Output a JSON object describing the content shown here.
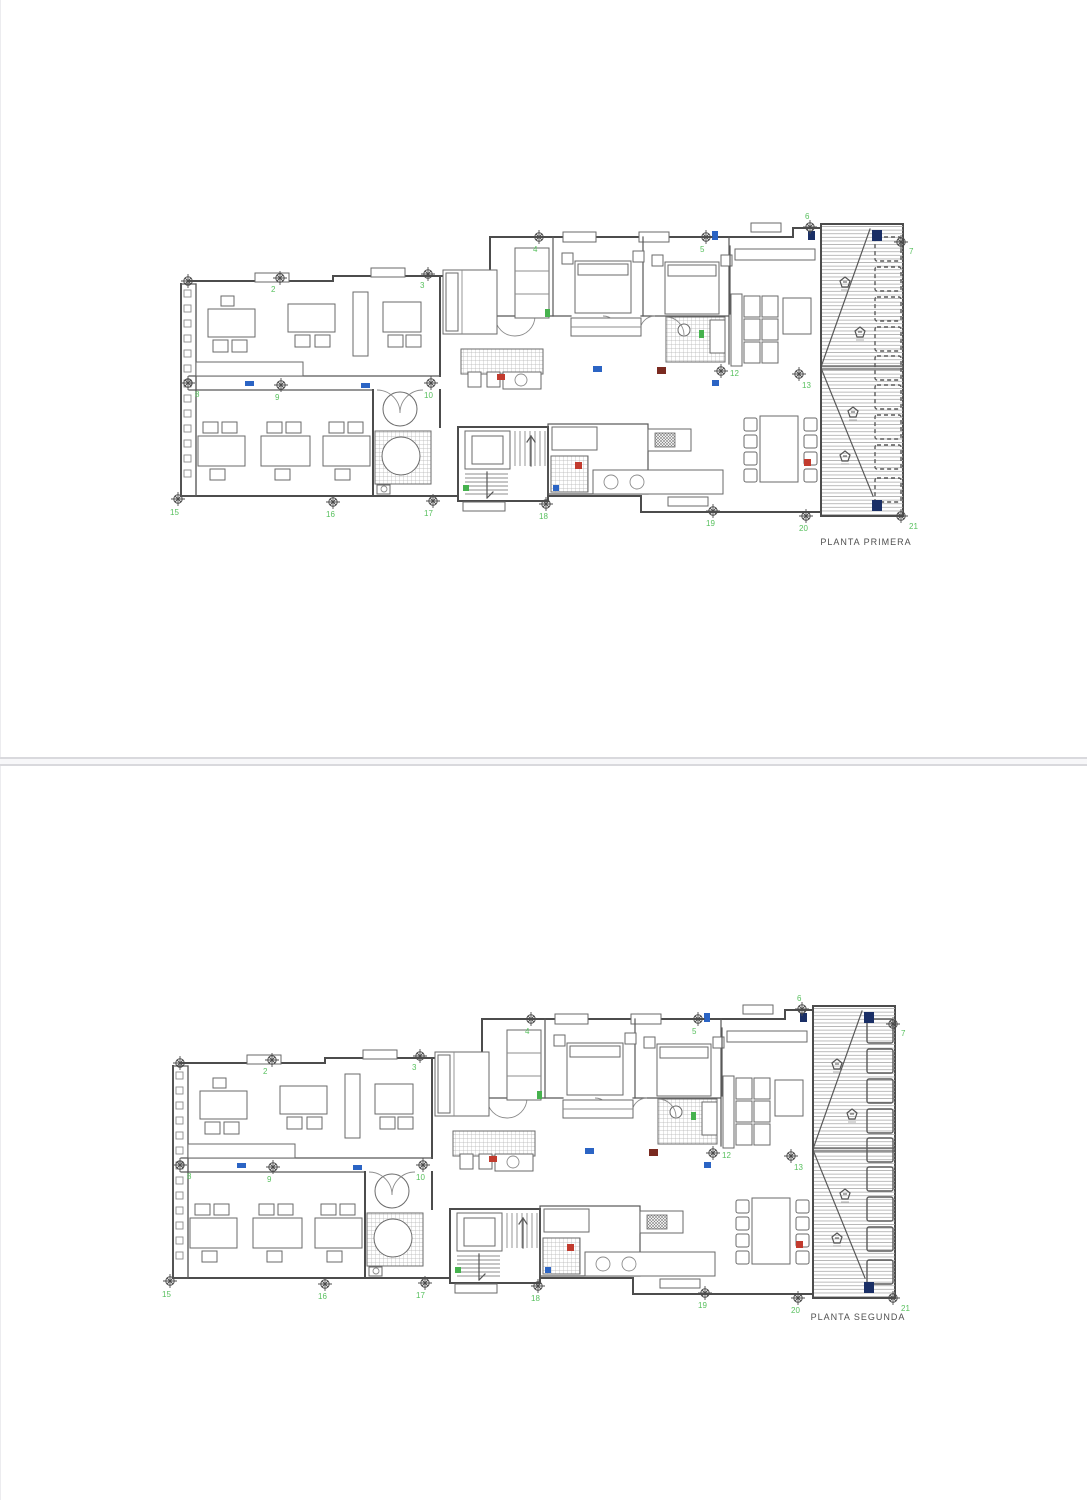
{
  "document": {
    "type": "architectural floor plans",
    "page_count": 2
  },
  "colors": {
    "wall": "#4c4c4c",
    "axis_green": "#58c05e",
    "blue": "#2b64c4",
    "navy": "#1a2f66",
    "red": "#c23b2e",
    "darkred": "#7a2a20",
    "green2": "#46b24e",
    "page_divider": "#d9d9dd"
  },
  "terrace": {
    "planter_ys": [
      33,
      63,
      93,
      123,
      152,
      181,
      211,
      241,
      274
    ],
    "slope_markers": [
      {
        "x": 682,
        "y": 78
      },
      {
        "x": 697,
        "y": 128
      },
      {
        "x": 690,
        "y": 208
      },
      {
        "x": 682,
        "y": 252
      }
    ]
  },
  "accent_marks": [
    {
      "c": "blue",
      "x": 82,
      "y": 177,
      "w": 9,
      "h": 5
    },
    {
      "c": "blue",
      "x": 198,
      "y": 179,
      "w": 9,
      "h": 5
    },
    {
      "c": "blue",
      "x": 430,
      "y": 162,
      "w": 9,
      "h": 6
    },
    {
      "c": "blue",
      "x": 549,
      "y": 176,
      "w": 7,
      "h": 6
    },
    {
      "c": "blue",
      "x": 549,
      "y": 27,
      "w": 6,
      "h": 9
    },
    {
      "c": "navy",
      "x": 645,
      "y": 27,
      "w": 7,
      "h": 9
    },
    {
      "c": "navy",
      "x": 709,
      "y": 26,
      "w": 10,
      "h": 11
    },
    {
      "c": "navy",
      "x": 709,
      "y": 296,
      "w": 10,
      "h": 11
    },
    {
      "c": "red",
      "x": 334,
      "y": 170,
      "w": 8,
      "h": 6
    },
    {
      "c": "darkred",
      "x": 494,
      "y": 163,
      "w": 9,
      "h": 7
    },
    {
      "c": "red",
      "x": 412,
      "y": 258,
      "w": 7,
      "h": 7
    },
    {
      "c": "red",
      "x": 641,
      "y": 255,
      "w": 7,
      "h": 7
    },
    {
      "c": "green2",
      "x": 382,
      "y": 105,
      "w": 5,
      "h": 8
    },
    {
      "c": "green2",
      "x": 536,
      "y": 126,
      "w": 5,
      "h": 8
    },
    {
      "c": "green2",
      "x": 300,
      "y": 281,
      "w": 6,
      "h": 6
    },
    {
      "c": "blue",
      "x": 390,
      "y": 281,
      "w": 6,
      "h": 6
    }
  ],
  "pages": [
    {
      "name": "page-1",
      "plan_label": "PLANTA PRIMERA",
      "planters_dashed": true,
      "axis_markers": [
        {
          "n": "",
          "x": 25,
          "y": 77
        },
        {
          "n": "2",
          "x": 117,
          "y": 74,
          "lx": 108,
          "ly": 88
        },
        {
          "n": "3",
          "x": 265,
          "y": 70,
          "lx": 257,
          "ly": 84
        },
        {
          "n": "4",
          "x": 376,
          "y": 33,
          "lx": 370,
          "ly": 48
        },
        {
          "n": "5",
          "x": 543,
          "y": 33,
          "lx": 537,
          "ly": 48
        },
        {
          "n": "6",
          "x": 647,
          "y": 23,
          "lx": 642,
          "ly": 15
        },
        {
          "n": "7",
          "x": 738,
          "y": 38,
          "lx": 746,
          "ly": 50
        },
        {
          "n": "8",
          "x": 25,
          "y": 179,
          "lx": 32,
          "ly": 193
        },
        {
          "n": "9",
          "x": 118,
          "y": 181,
          "lx": 112,
          "ly": 196
        },
        {
          "n": "10",
          "x": 268,
          "y": 179,
          "lx": 261,
          "ly": 194
        },
        {
          "n": "12",
          "x": 558,
          "y": 167,
          "lx": 567,
          "ly": 172
        },
        {
          "n": "13",
          "x": 636,
          "y": 170,
          "lx": 639,
          "ly": 184
        },
        {
          "n": "15",
          "x": 15,
          "y": 295,
          "lx": 7,
          "ly": 311
        },
        {
          "n": "16",
          "x": 170,
          "y": 298,
          "lx": 163,
          "ly": 313
        },
        {
          "n": "17",
          "x": 270,
          "y": 297,
          "lx": 261,
          "ly": 312
        },
        {
          "n": "18",
          "x": 383,
          "y": 300,
          "lx": 376,
          "ly": 315
        },
        {
          "n": "19",
          "x": 550,
          "y": 307,
          "lx": 543,
          "ly": 322
        },
        {
          "n": "20",
          "x": 643,
          "y": 312,
          "lx": 636,
          "ly": 327
        },
        {
          "n": "21",
          "x": 738,
          "y": 312,
          "lx": 746,
          "ly": 325
        }
      ]
    },
    {
      "name": "page-2",
      "plan_label": "PLANTA SEGUNDA",
      "planters_dashed": false,
      "axis_markers": [
        {
          "n": "",
          "x": 25,
          "y": 77
        },
        {
          "n": "2",
          "x": 117,
          "y": 74,
          "lx": 108,
          "ly": 88
        },
        {
          "n": "3",
          "x": 265,
          "y": 70,
          "lx": 257,
          "ly": 84
        },
        {
          "n": "4",
          "x": 376,
          "y": 33,
          "lx": 370,
          "ly": 48
        },
        {
          "n": "5",
          "x": 543,
          "y": 33,
          "lx": 537,
          "ly": 48
        },
        {
          "n": "6",
          "x": 647,
          "y": 23,
          "lx": 642,
          "ly": 15
        },
        {
          "n": "7",
          "x": 738,
          "y": 38,
          "lx": 746,
          "ly": 50
        },
        {
          "n": "8",
          "x": 25,
          "y": 179,
          "lx": 32,
          "ly": 193
        },
        {
          "n": "9",
          "x": 118,
          "y": 181,
          "lx": 112,
          "ly": 196
        },
        {
          "n": "10",
          "x": 268,
          "y": 179,
          "lx": 261,
          "ly": 194
        },
        {
          "n": "12",
          "x": 558,
          "y": 167,
          "lx": 567,
          "ly": 172
        },
        {
          "n": "13",
          "x": 636,
          "y": 170,
          "lx": 639,
          "ly": 184
        },
        {
          "n": "15",
          "x": 15,
          "y": 295,
          "lx": 7,
          "ly": 311
        },
        {
          "n": "16",
          "x": 170,
          "y": 298,
          "lx": 163,
          "ly": 313
        },
        {
          "n": "17",
          "x": 270,
          "y": 297,
          "lx": 261,
          "ly": 312
        },
        {
          "n": "18",
          "x": 383,
          "y": 300,
          "lx": 376,
          "ly": 315
        },
        {
          "n": "19",
          "x": 550,
          "y": 307,
          "lx": 543,
          "ly": 322
        },
        {
          "n": "20",
          "x": 643,
          "y": 312,
          "lx": 636,
          "ly": 327
        },
        {
          "n": "21",
          "x": 738,
          "y": 312,
          "lx": 746,
          "ly": 325
        }
      ]
    }
  ]
}
